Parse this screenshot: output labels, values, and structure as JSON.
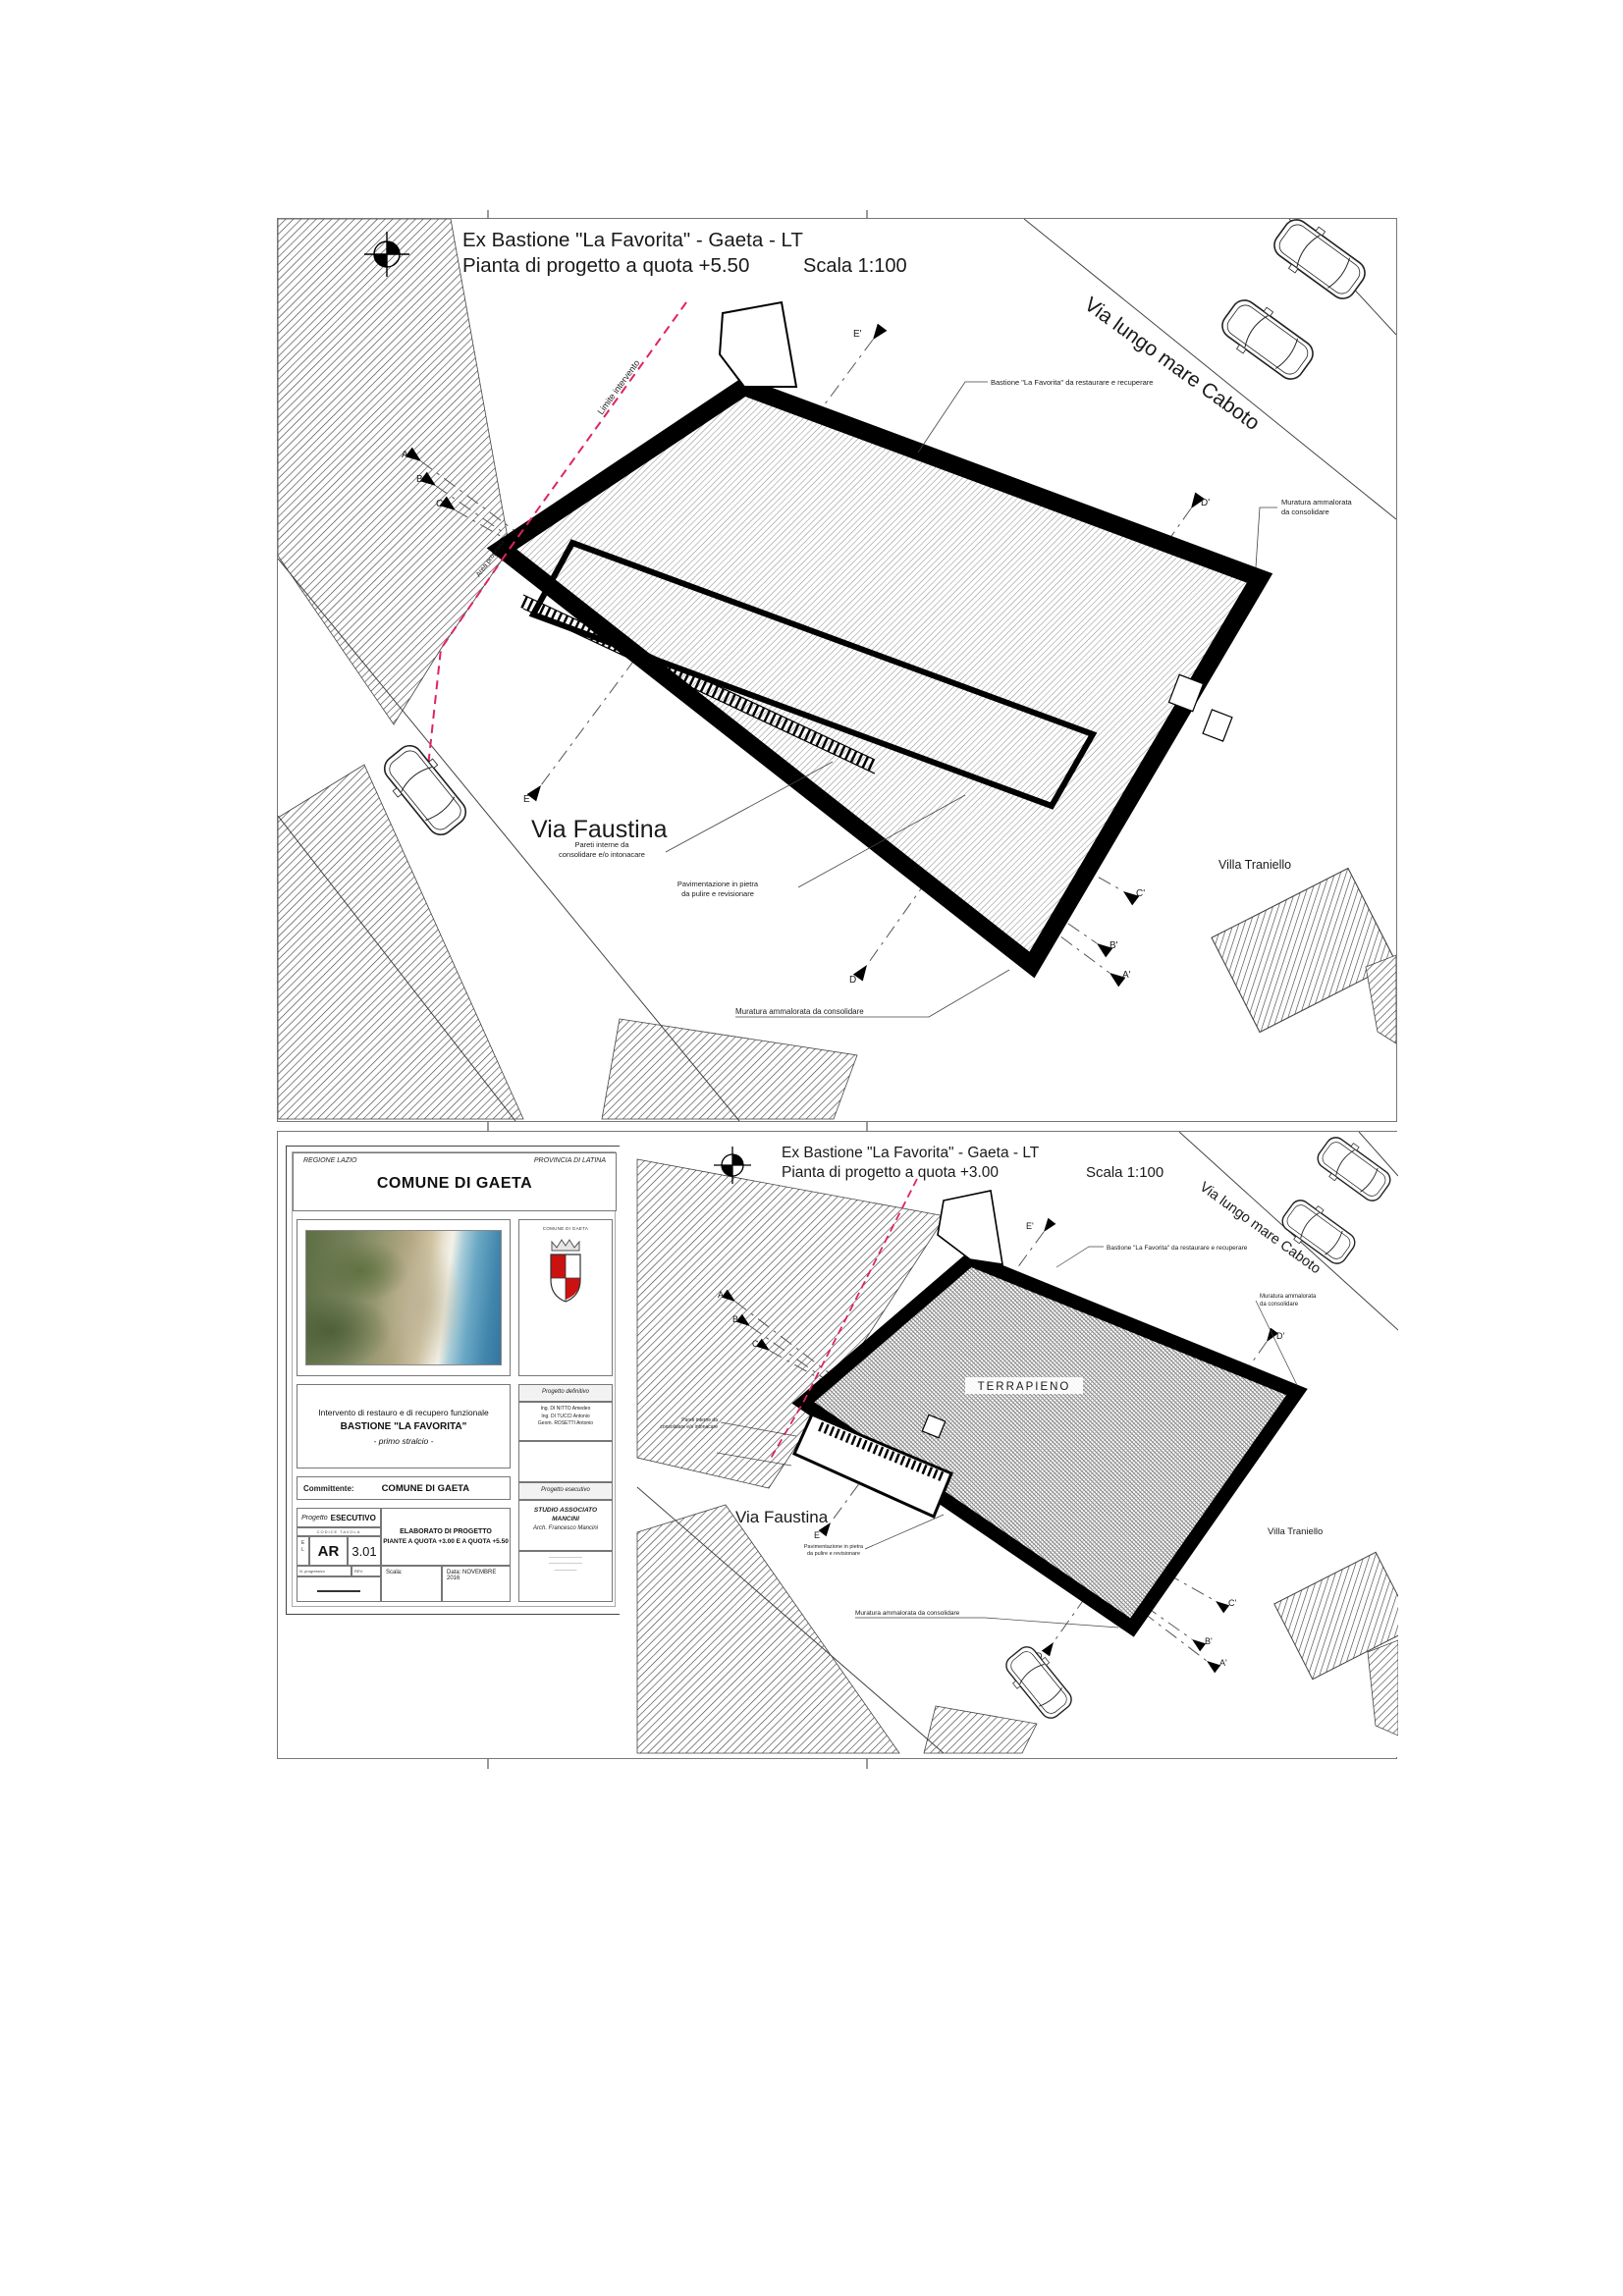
{
  "sheet1": {
    "title_line1": "Ex Bastione \"La Favorita\" - Gaeta - LT",
    "title_line2": "Pianta di progetto a quota +5.50",
    "scale": "Scala 1:100"
  },
  "sheet2": {
    "title_line1": "Ex Bastione \"La Favorita\" - Gaeta - LT",
    "title_line2": "Pianta di progetto a quota +3.00",
    "scale": "Scala 1:100",
    "terrapieno": "TERRAPIENO"
  },
  "map": {
    "via_lungomare": "Via lungo mare Caboto",
    "via_faustina": "Via Faustina",
    "villa_traniello": "Villa Traniello",
    "limite_intervento": "Limite intervento",
    "area_proprieta": "Area proprietà"
  },
  "annotations": {
    "bastione": "Bastione \"La Favorita\" da restaurare e recuperare",
    "muratura_1": "Muratura ammalorata",
    "muratura_2": "da consolidare",
    "muratura_full": "Muratura ammalorata da consolidare",
    "pareti_1": "Pareti interne da",
    "pareti_2": "consolidare e/o intonacare",
    "pavimentazione_1": "Pavimentazione in pietra",
    "pavimentazione_2": "da pulire e revisionare"
  },
  "sections": {
    "a": "A",
    "b": "B",
    "c": "C",
    "d": "D",
    "e": "E",
    "a1": "A'",
    "b1": "B'",
    "c1": "C'",
    "d1": "D'",
    "e1": "E'"
  },
  "titleblock": {
    "regione": "REGIONE LAZIO",
    "provincia": "PROVINCIA DI LATINA",
    "comune": "COMUNE DI GAETA",
    "crest_caption": "COMUNE DI GAETA",
    "progetto_titolo_1": "Intervento di restauro e di recupero funzionale",
    "progetto_titolo_2": "BASTIONE \"LA FAVORITA\"",
    "progetto_titolo_3": "- primo stralcio -",
    "committente_label": "Committente:",
    "committente_value": "COMUNE DI GAETA",
    "progetto_label_1": "Progetto",
    "progetto_label_2": "ESECUTIVO",
    "codice_tavola": "CODICE TAVOLA",
    "tav_l1": "E",
    "tav_l2": "L",
    "code_prefix": "AR",
    "code_number": "3.01",
    "n_progressivo": "N. progressivo",
    "rev_label": "REV.",
    "elaborato_1": "ELABORATO DI PROGETTO",
    "elaborato_2": "PIANTE A QUOTA +3.00 E A QUOTA +5.50",
    "scala_label": "Scala:",
    "data_label": "Data:",
    "data_value": "NOVEMBRE 2016",
    "right": {
      "def_header": "Progetto definitivo",
      "def_name_1": "Ing. DI NITTO Amedeo",
      "def_name_2": "Ing. DI TUCCI Antonio",
      "def_name_3": "Geom. ROSETTI Antonio",
      "ese_header": "Progetto esecutivo",
      "ese_line_1": "STUDIO ASSOCIATO",
      "ese_line_2": "MANCINI",
      "ese_line_3": "Arch. Francesco Mancini"
    }
  }
}
